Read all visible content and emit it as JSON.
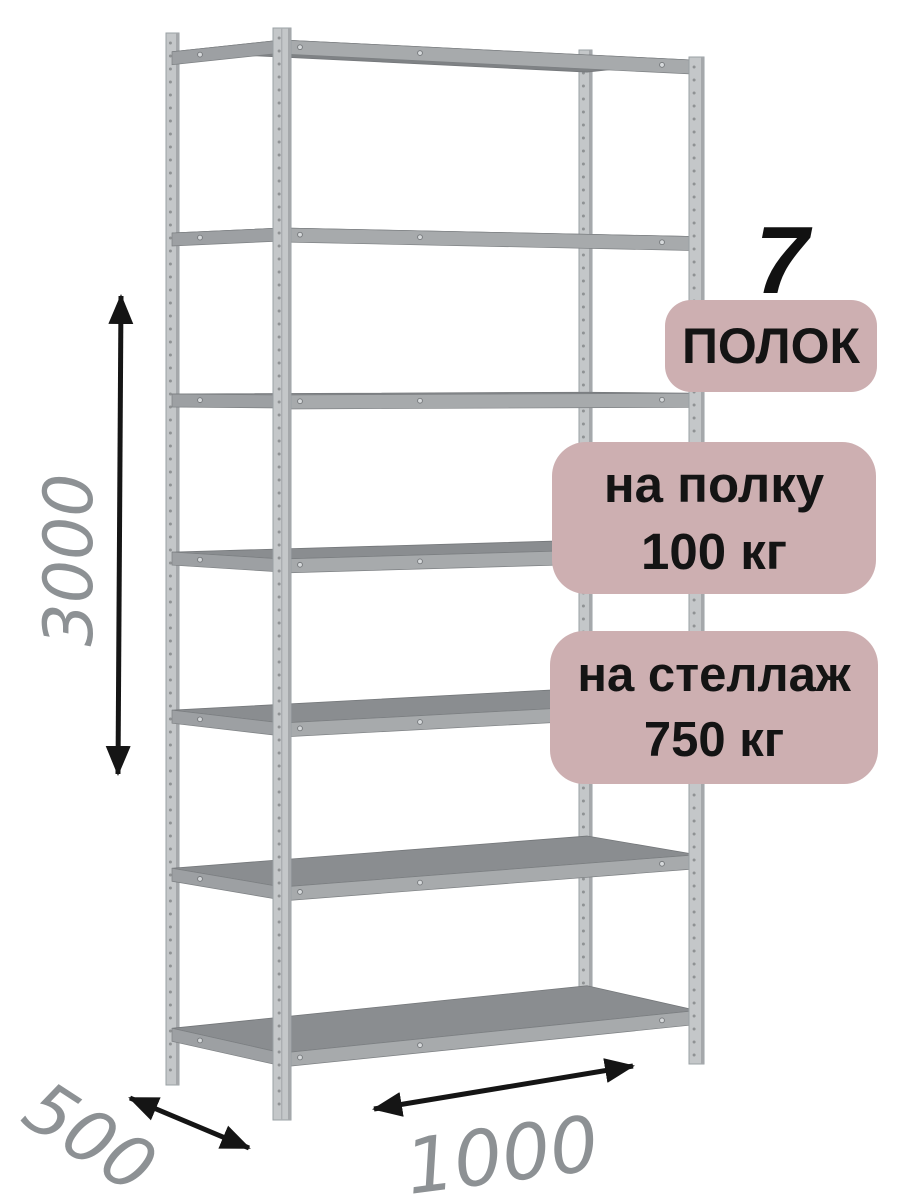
{
  "annotations": {
    "shelf_count": {
      "number": "7",
      "label": "ПОЛОК"
    },
    "per_shelf_load": {
      "line1": "на полку",
      "line2": "100 кг"
    },
    "per_rack_load": {
      "line1": "на стеллаж",
      "line2": "750 кг"
    }
  },
  "dimensions": {
    "height": {
      "value": "3000"
    },
    "width": {
      "value": "1000"
    },
    "depth": {
      "value": "500"
    }
  },
  "rack": {
    "shelf_count": 7,
    "upright_count": 4
  },
  "colors": {
    "background": "#ffffff",
    "badge_bg": "#cdafb1",
    "badge_text": "#141414",
    "seven_text": "#111111",
    "metal_post": "#c4c7c9",
    "metal_shelf_top": "#8a8d90",
    "metal_shelf_top_underside": "#7f8285",
    "metal_front_band": "#a7aaac",
    "metal_side_band": "#9da0a3",
    "dimension_text": "#8d9194",
    "arrow": "#151515"
  }
}
